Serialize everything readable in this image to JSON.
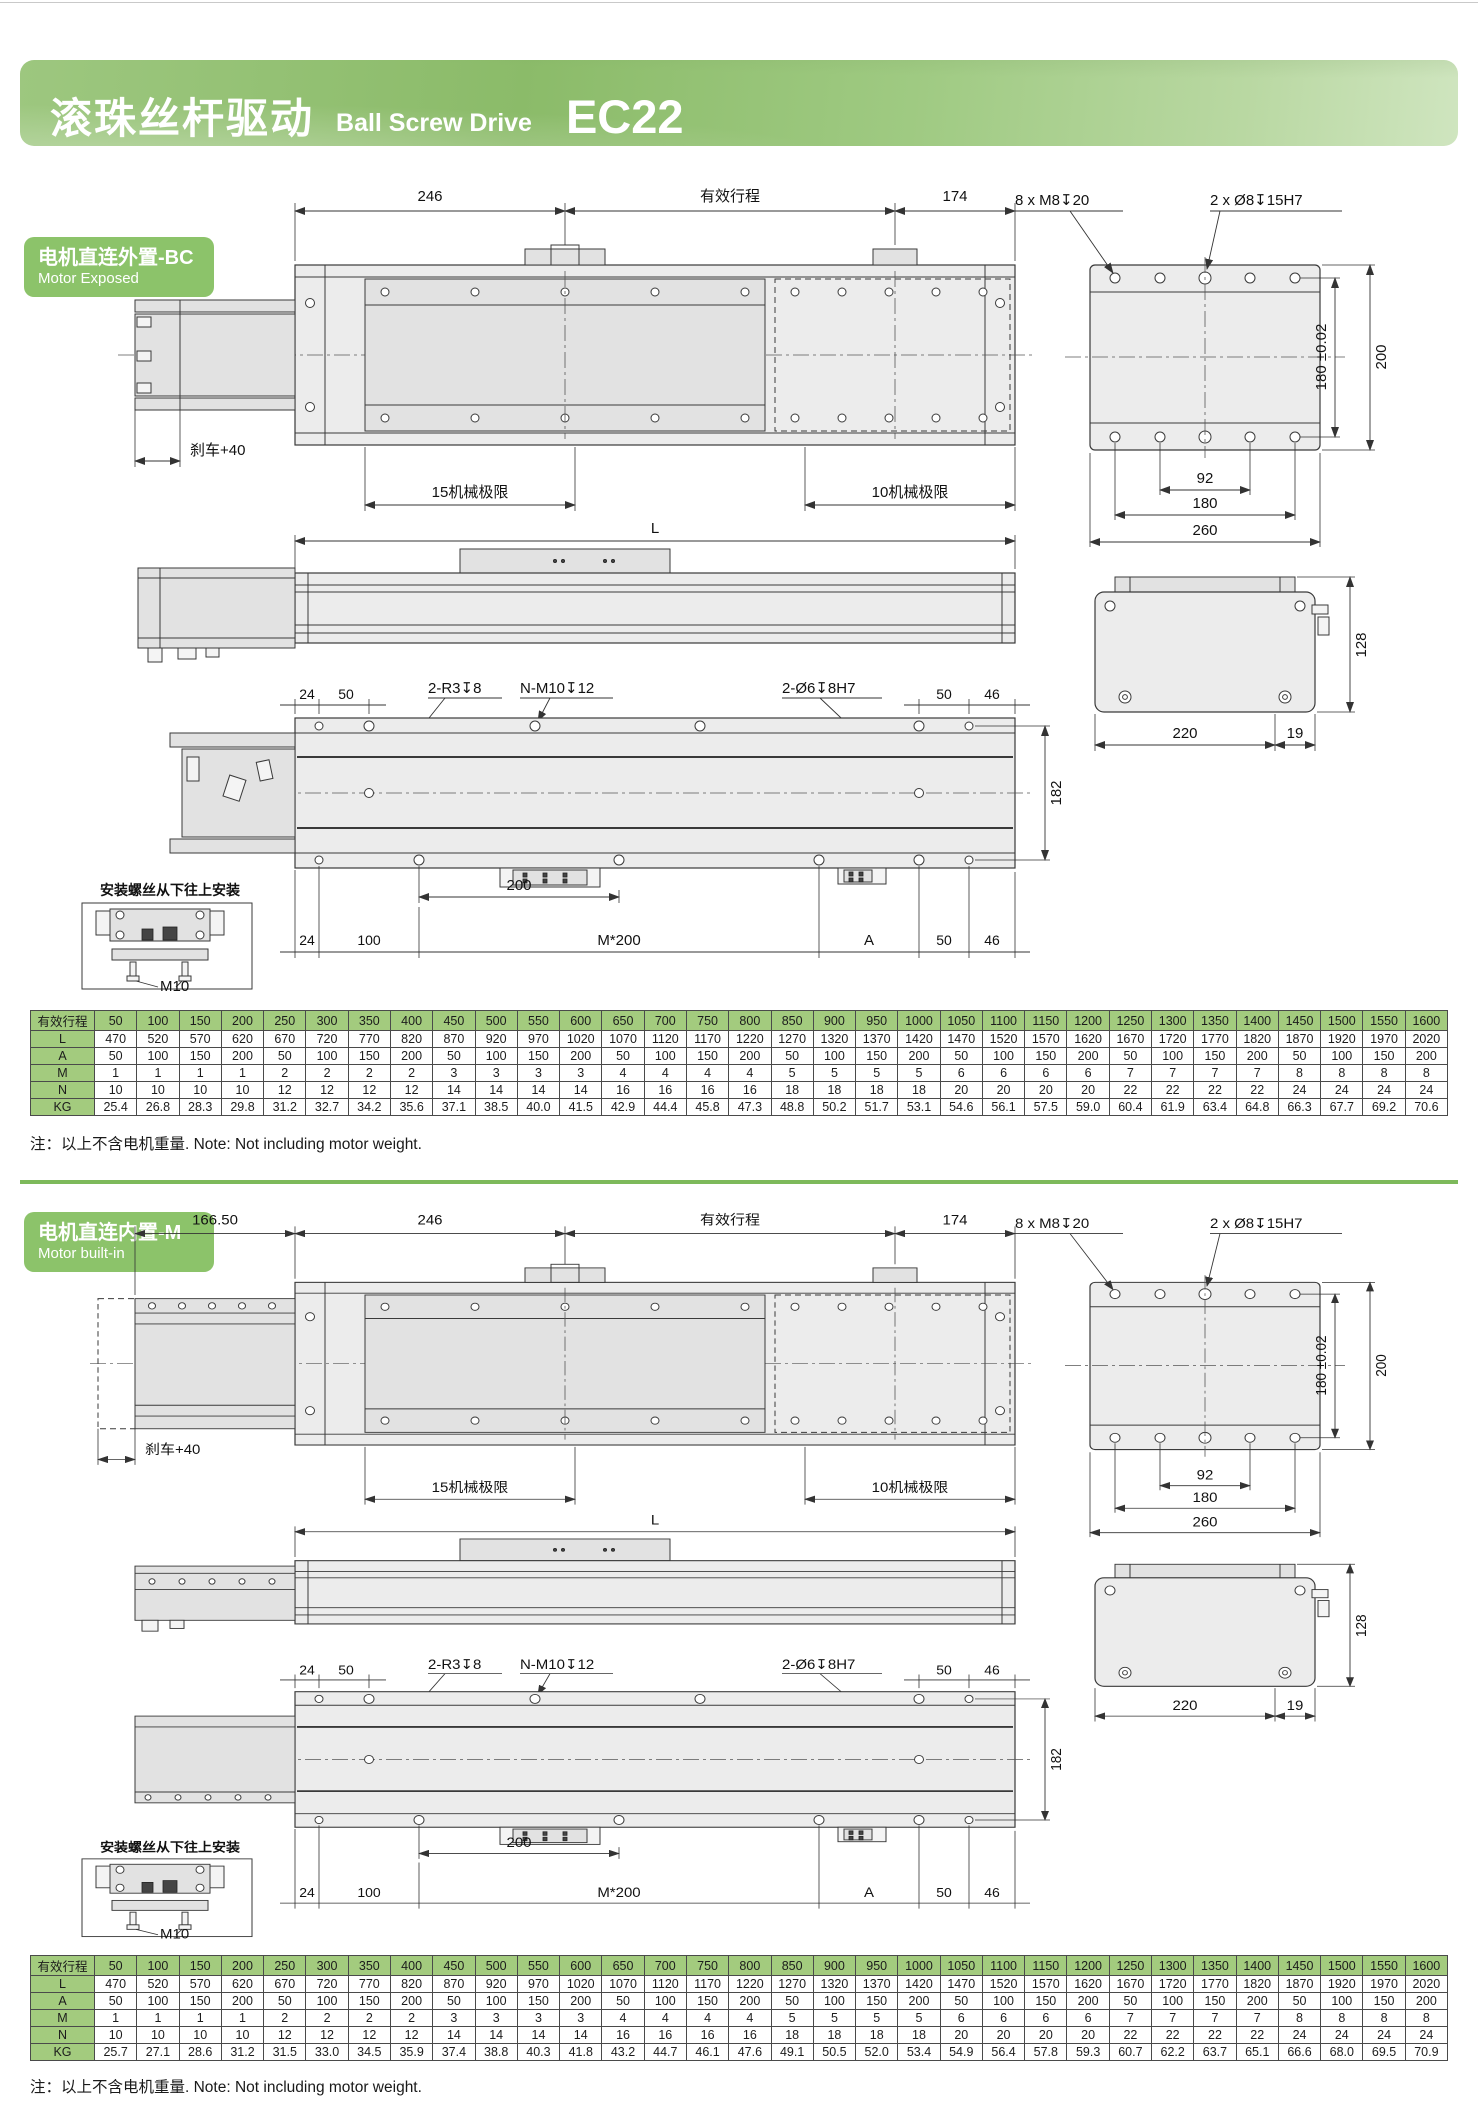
{
  "header": {
    "title_zh": "滚珠丝杆驱动",
    "title_en": "Ball Screw Drive",
    "model": "EC22"
  },
  "sections": [
    {
      "label_zh": "电机直连外置-BC",
      "label_en": "Motor Exposed"
    },
    {
      "label_zh": "电机直连内置-M",
      "label_en": "Motor built-in"
    }
  ],
  "dims": {
    "d246": "246",
    "stroke": "有效行程",
    "d174": "174",
    "d166": "166.50",
    "m8": "8 x M8↧20",
    "phi8": "2 x Ø8↧15H7",
    "t180": "180 ±0.02",
    "d200": "200",
    "d92": "92",
    "d180": "180",
    "d260": "260",
    "brake": "刹车+40",
    "lim15": "15机械极限",
    "lim10": "10机械极限",
    "L": "L",
    "d128": "128",
    "d220": "220",
    "d19": "19",
    "d24": "24",
    "d50": "50",
    "d46": "46",
    "d100": "100",
    "d182": "182",
    "d200b": "200",
    "r3": "2-R3↧8",
    "nm10": "N-M10↧12",
    "phi6": "2-Ø6↧8H7",
    "m200": "M*200",
    "A": "A",
    "inset": "安装螺丝从下往上安装",
    "m10": "M10"
  },
  "note": "注：以上不含电机重量. Note: Not including motor weight.",
  "tables": [
    {
      "header_label": "有效行程",
      "strokes": [
        "50",
        "100",
        "150",
        "200",
        "250",
        "300",
        "350",
        "400",
        "450",
        "500",
        "550",
        "600",
        "650",
        "700",
        "750",
        "800",
        "850",
        "900",
        "950",
        "1000",
        "1050",
        "1100",
        "1150",
        "1200",
        "1250",
        "1300",
        "1350",
        "1400",
        "1450",
        "1500",
        "1550",
        "1600"
      ],
      "rows": [
        {
          "label": "L",
          "values": [
            "470",
            "520",
            "570",
            "620",
            "670",
            "720",
            "770",
            "820",
            "870",
            "920",
            "970",
            "1020",
            "1070",
            "1120",
            "1170",
            "1220",
            "1270",
            "1320",
            "1370",
            "1420",
            "1470",
            "1520",
            "1570",
            "1620",
            "1670",
            "1720",
            "1770",
            "1820",
            "1870",
            "1920",
            "1970",
            "2020"
          ]
        },
        {
          "label": "A",
          "values": [
            "50",
            "100",
            "150",
            "200",
            "50",
            "100",
            "150",
            "200",
            "50",
            "100",
            "150",
            "200",
            "50",
            "100",
            "150",
            "200",
            "50",
            "100",
            "150",
            "200",
            "50",
            "100",
            "150",
            "200",
            "50",
            "100",
            "150",
            "200",
            "50",
            "100",
            "150",
            "200"
          ]
        },
        {
          "label": "M",
          "values": [
            "1",
            "1",
            "1",
            "1",
            "2",
            "2",
            "2",
            "2",
            "3",
            "3",
            "3",
            "3",
            "4",
            "4",
            "4",
            "4",
            "5",
            "5",
            "5",
            "5",
            "6",
            "6",
            "6",
            "6",
            "7",
            "7",
            "7",
            "7",
            "8",
            "8",
            "8",
            "8"
          ]
        },
        {
          "label": "N",
          "values": [
            "10",
            "10",
            "10",
            "10",
            "12",
            "12",
            "12",
            "12",
            "14",
            "14",
            "14",
            "14",
            "16",
            "16",
            "16",
            "16",
            "18",
            "18",
            "18",
            "18",
            "20",
            "20",
            "20",
            "20",
            "22",
            "22",
            "22",
            "22",
            "24",
            "24",
            "24",
            "24"
          ]
        },
        {
          "label": "KG",
          "values": [
            "25.4",
            "26.8",
            "28.3",
            "29.8",
            "31.2",
            "32.7",
            "34.2",
            "35.6",
            "37.1",
            "38.5",
            "40.0",
            "41.5",
            "42.9",
            "44.4",
            "45.8",
            "47.3",
            "48.8",
            "50.2",
            "51.7",
            "53.1",
            "54.6",
            "56.1",
            "57.5",
            "59.0",
            "60.4",
            "61.9",
            "63.4",
            "64.8",
            "66.3",
            "67.7",
            "69.2",
            "70.6"
          ]
        }
      ]
    },
    {
      "header_label": "有效行程",
      "strokes": [
        "50",
        "100",
        "150",
        "200",
        "250",
        "300",
        "350",
        "400",
        "450",
        "500",
        "550",
        "600",
        "650",
        "700",
        "750",
        "800",
        "850",
        "900",
        "950",
        "1000",
        "1050",
        "1100",
        "1150",
        "1200",
        "1250",
        "1300",
        "1350",
        "1400",
        "1450",
        "1500",
        "1550",
        "1600"
      ],
      "rows": [
        {
          "label": "L",
          "values": [
            "470",
            "520",
            "570",
            "620",
            "670",
            "720",
            "770",
            "820",
            "870",
            "920",
            "970",
            "1020",
            "1070",
            "1120",
            "1170",
            "1220",
            "1270",
            "1320",
            "1370",
            "1420",
            "1470",
            "1520",
            "1570",
            "1620",
            "1670",
            "1720",
            "1770",
            "1820",
            "1870",
            "1920",
            "1970",
            "2020"
          ]
        },
        {
          "label": "A",
          "values": [
            "50",
            "100",
            "150",
            "200",
            "50",
            "100",
            "150",
            "200",
            "50",
            "100",
            "150",
            "200",
            "50",
            "100",
            "150",
            "200",
            "50",
            "100",
            "150",
            "200",
            "50",
            "100",
            "150",
            "200",
            "50",
            "100",
            "150",
            "200",
            "50",
            "100",
            "150",
            "200"
          ]
        },
        {
          "label": "M",
          "values": [
            "1",
            "1",
            "1",
            "1",
            "2",
            "2",
            "2",
            "2",
            "3",
            "3",
            "3",
            "3",
            "4",
            "4",
            "4",
            "4",
            "5",
            "5",
            "5",
            "5",
            "6",
            "6",
            "6",
            "6",
            "7",
            "7",
            "7",
            "7",
            "8",
            "8",
            "8",
            "8"
          ]
        },
        {
          "label": "N",
          "values": [
            "10",
            "10",
            "10",
            "10",
            "12",
            "12",
            "12",
            "12",
            "14",
            "14",
            "14",
            "14",
            "16",
            "16",
            "16",
            "16",
            "18",
            "18",
            "18",
            "18",
            "20",
            "20",
            "20",
            "20",
            "22",
            "22",
            "22",
            "22",
            "24",
            "24",
            "24",
            "24"
          ]
        },
        {
          "label": "KG",
          "values": [
            "25.7",
            "27.1",
            "28.6",
            "31.2",
            "31.5",
            "33.0",
            "34.5",
            "35.9",
            "37.4",
            "38.8",
            "40.3",
            "41.8",
            "43.2",
            "44.7",
            "46.1",
            "47.6",
            "49.1",
            "50.5",
            "52.0",
            "53.4",
            "54.9",
            "56.4",
            "57.8",
            "59.3",
            "60.7",
            "62.2",
            "63.7",
            "65.1",
            "66.6",
            "68.0",
            "69.5",
            "70.9"
          ]
        }
      ]
    }
  ]
}
